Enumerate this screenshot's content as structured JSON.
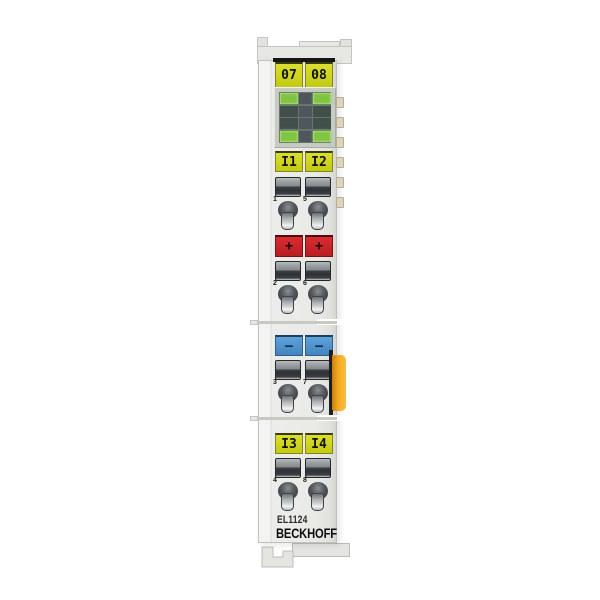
{
  "device": {
    "model": "EL1124",
    "brand": "BECKHOFF"
  },
  "plates": {
    "id_top": [
      "07",
      "08"
    ],
    "input_upper": [
      "I1",
      "I2"
    ],
    "plus": [
      "+",
      "+"
    ],
    "minus": [
      "–",
      "–"
    ],
    "input_lower": [
      "I3",
      "I4"
    ]
  },
  "contact_numbers": [
    "1",
    "5",
    "2",
    "6",
    "3",
    "7",
    "4",
    "8"
  ],
  "led_block": {
    "rows": [
      {
        "left": "on",
        "right": "on"
      },
      {
        "left": "off",
        "right": "off"
      },
      {
        "left": "off",
        "right": "off"
      },
      {
        "left": "on",
        "right": "on"
      }
    ]
  },
  "colors": {
    "label_yellow": "#c3ca12",
    "label_red": "#b81d22",
    "label_blue": "#4384bf",
    "led_on_green": "#7fc442",
    "led_off_dark": "#41504a",
    "latch_orange": "#f5ac20",
    "ebus_beige": "#dcd5bb",
    "body_gray": "#eaeae7"
  }
}
